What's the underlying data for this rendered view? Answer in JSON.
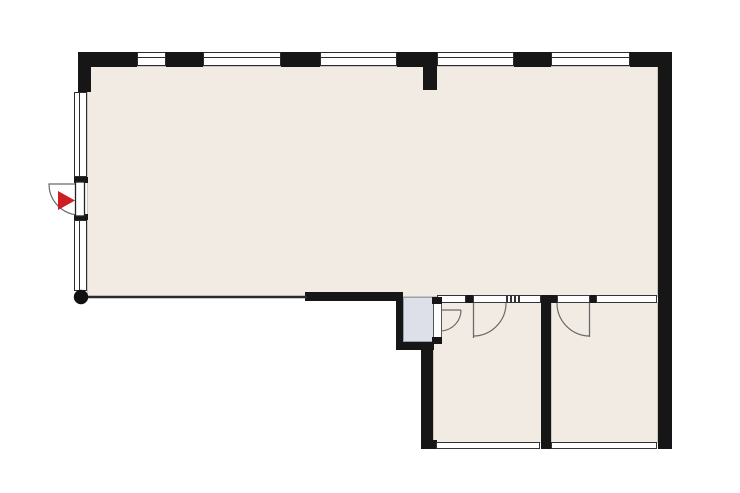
{
  "plan": {
    "type": "apartment-floor-plan",
    "colors": {
      "wall": "#161616",
      "room_fill": "#f2ebe4",
      "shaft_fill": "#dde0e9",
      "accent": "#cd1d26",
      "doorline": "#6a6a6a"
    },
    "rooms": [
      {
        "name": "main-room"
      },
      {
        "name": "room-bottom-left"
      },
      {
        "name": "room-bottom-right"
      },
      {
        "name": "shaft"
      }
    ],
    "inventory": {
      "top_wall_windows": 5,
      "left_wall_windows": 2,
      "lower_band_windows": 3,
      "bottom_wall_windows": 2,
      "entrance_doors": 1,
      "interior_doors": 3,
      "entrance_arrow_marker": 1,
      "column_marker": 1
    }
  }
}
